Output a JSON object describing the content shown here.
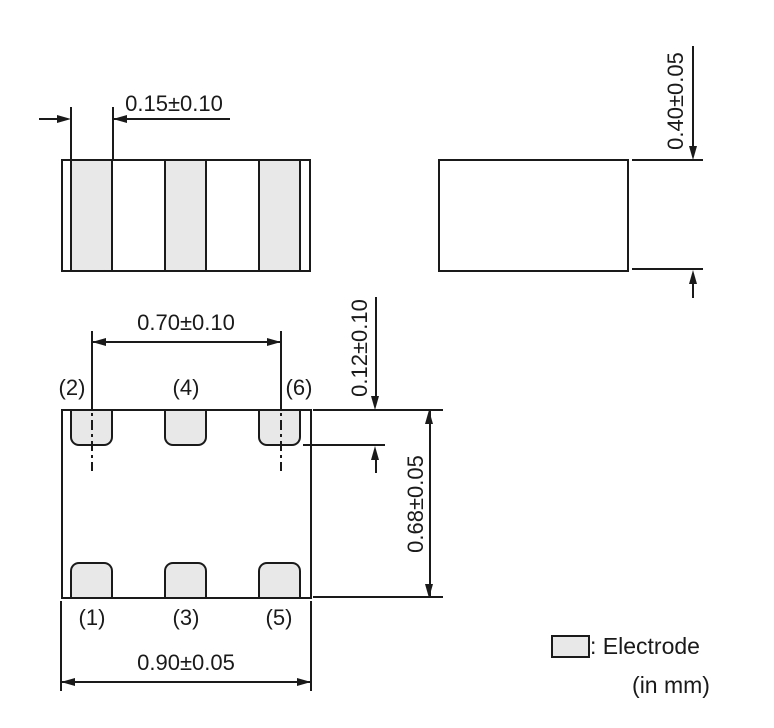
{
  "colors": {
    "line": "#1a1a1a",
    "electrode_fill": "#e8e8e8",
    "background": "#ffffff"
  },
  "views": {
    "side_view": {
      "electrode_width_dim": "0.15±0.10"
    },
    "end_view": {
      "height_dim": "0.40±0.05"
    },
    "bottom_view": {
      "pitch_dim": "0.70±0.10",
      "length_dim": "0.90±0.05",
      "width_dim": "0.68±0.05",
      "electrode_depth_dim": "0.12±0.10",
      "terminals_top": [
        "(2)",
        "(4)",
        "(6)"
      ],
      "terminals_bottom": [
        "(1)",
        "(3)",
        "(5)"
      ]
    }
  },
  "legend": {
    "electrode_label": ": Electrode",
    "units_label": "(in mm)"
  }
}
